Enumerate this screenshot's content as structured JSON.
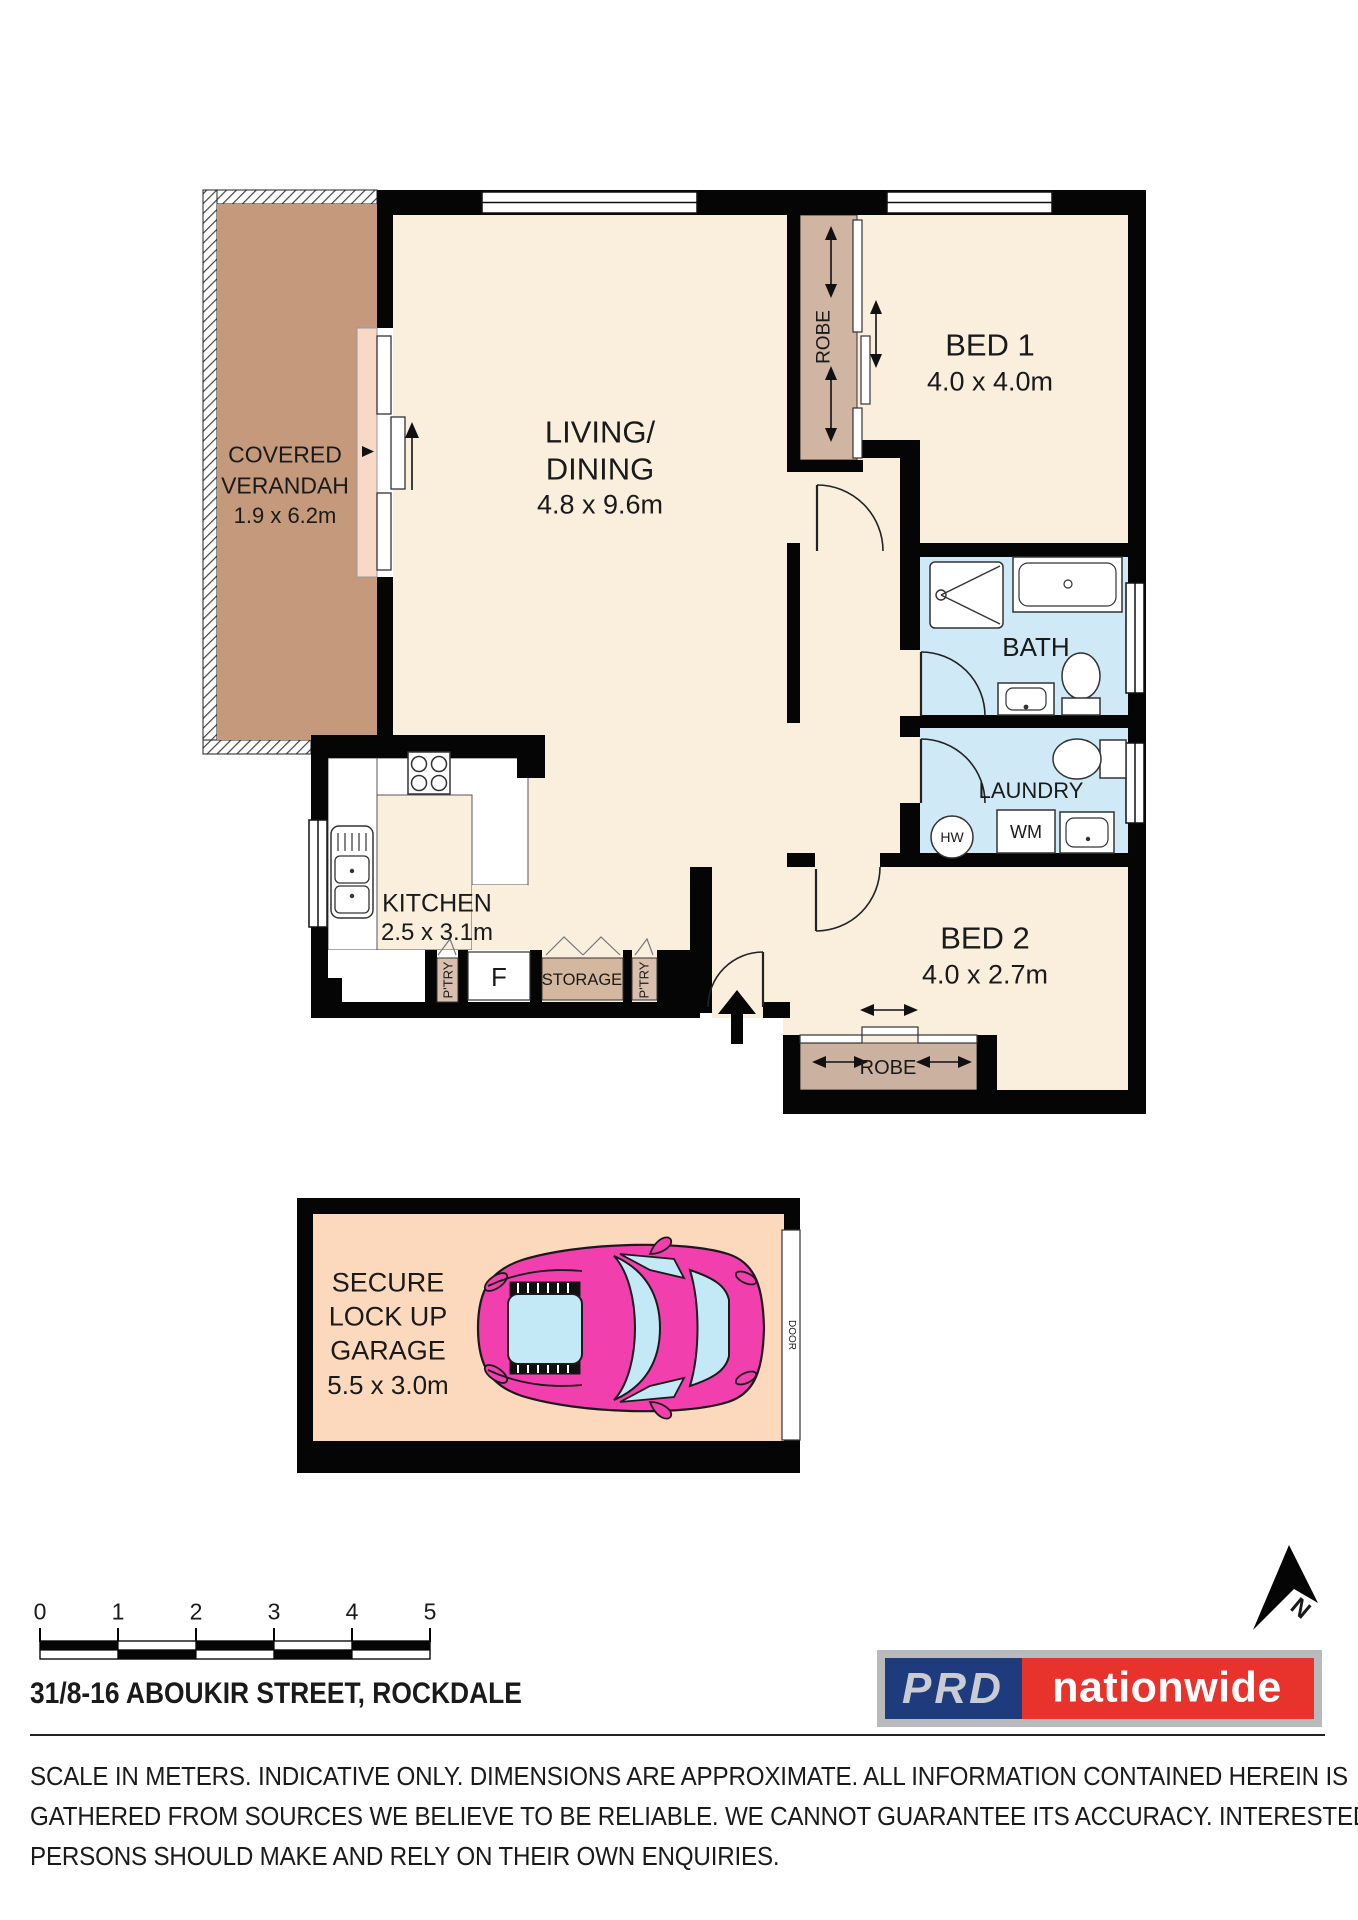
{
  "plan": {
    "verandah": {
      "line1": "COVERED",
      "line2": "VERANDAH",
      "dims": "1.9 x 6.2m"
    },
    "living": {
      "line1": "LIVING/",
      "line2": "DINING",
      "dims": "4.8 x 9.6m"
    },
    "bed1": {
      "name": "BED 1",
      "dims": "4.0 x 4.0m"
    },
    "bed2": {
      "name": "BED 2",
      "dims": "4.0 x 2.7m"
    },
    "bath": {
      "name": "BATH"
    },
    "laundry": {
      "name": "LAUNDRY",
      "hw": "HW",
      "wm": "WM"
    },
    "kitchen": {
      "name": "KITCHEN",
      "dims": "2.5 x 3.1m"
    },
    "robe1": "ROBE",
    "robe2": "ROBE",
    "pantry1": "P'TRY",
    "pantry2": "P'TRY",
    "fridge": "F",
    "storage": "STORAGE"
  },
  "garage": {
    "lines": [
      "SECURE",
      "LOCK UP",
      "GARAGE",
      "5.5 x 3.0m"
    ],
    "door": "DOOR"
  },
  "compass": {
    "north": "N"
  },
  "scale": {
    "marks": [
      "0",
      "1",
      "2",
      "3",
      "4",
      "5"
    ]
  },
  "footer": {
    "address": "31/8-16 ABOUKIR STREET, ROCKDALE",
    "logo": {
      "prd": "PRD",
      "nationwide": "nationwide"
    },
    "disclaimer": [
      "SCALE IN METERS. INDICATIVE ONLY. DIMENSIONS ARE APPROXIMATE. ALL INFORMATION CONTAINED HEREIN IS",
      "GATHERED FROM SOURCES WE BELIEVE TO BE RELIABLE. WE CANNOT GUARANTEE ITS ACCURACY. INTERESTED",
      "PERSONS SHOULD MAKE AND RELY ON THEIR OWN ENQUIRIES."
    ]
  },
  "colors": {
    "room_cream": "#faeedc",
    "verandah_brown": "#c59a7c",
    "wet_area_blue": "#cfe9f7",
    "robe_tan": "#d0b5a3",
    "garage_peach": "#fcd9bd",
    "car_pink": "#f23fae",
    "car_glass": "#c4e9f6",
    "prd_blue": "#1e3c7d",
    "prd_red": "#e8322c",
    "wall_black": "#050505"
  }
}
